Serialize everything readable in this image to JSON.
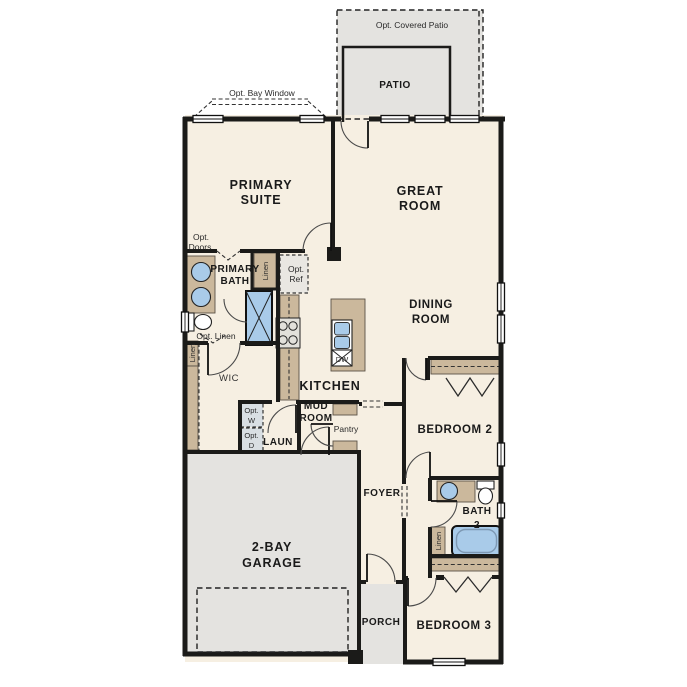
{
  "plan": {
    "colors": {
      "cream": "#F6EFE2",
      "gray": "#E4E3E0",
      "tan": "#CBB89C",
      "blue": "#A9CBE9",
      "wall": "#1B1B19",
      "steel": "#D9DFE3",
      "refgray": "#E9E7E2",
      "stovegray": "#E2E0DB"
    },
    "labels": {
      "covered_patio": "Opt. Covered Patio",
      "patio": "PATIO",
      "bay_window": "Opt. Bay Window",
      "primary_suite_l1": "PRIMARY",
      "primary_suite_l2": "SUITE",
      "great_room_l1": "GREAT",
      "great_room_l2": "ROOM",
      "dining_l1": "DINING",
      "dining_l2": "ROOM",
      "primary_bath_l1": "PRIMARY",
      "primary_bath_l2": "BATH",
      "opt_doors_l1": "Opt.",
      "opt_doors_l2": "Doors",
      "opt_linen": "Opt. Linen",
      "opt_ref_l1": "Opt.",
      "opt_ref_l2": "Ref",
      "linen": "Linen",
      "wic": "WIC",
      "kitchen": "KITCHEN",
      "mud_l1": "MUD",
      "mud_l2": "ROOM",
      "pantry": "Pantry",
      "laundry": "LAUN",
      "opt_w_l1": "Opt.",
      "opt_w_l2": "W",
      "opt_d_l1": "Opt.",
      "opt_d_l2": "D",
      "dishwasher": "DW",
      "foyer": "FOYER",
      "bedroom2": "BEDROOM 2",
      "bath2_l1": "BATH",
      "bath2_l2": "2",
      "bedroom3": "BEDROOM 3",
      "porch": "PORCH",
      "garage_l1": "2-BAY",
      "garage_l2": "GARAGE"
    }
  }
}
